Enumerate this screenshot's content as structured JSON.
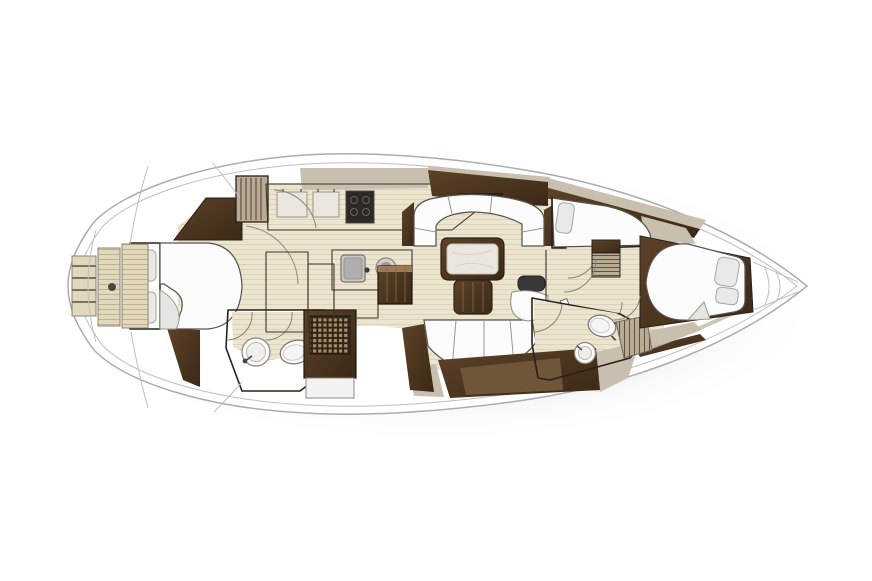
{
  "figure": {
    "kind": "sailing-yacht-interior-floor-plan",
    "view": "top-down deck plan",
    "bow_direction": "right",
    "stern_direction": "left"
  },
  "areas": {
    "swim_platform": "transom swim platform with teak steps",
    "aft_cabin": "aft double berth cabin",
    "aft_head": "aft head with sink and toilet",
    "shower": "shower with teak grate",
    "galley": "galley with sink, stove and counters",
    "companionway": "companionway steps",
    "saloon": "saloon with dinette table and settees",
    "nav_seat": "navigation seat",
    "guest_cabin": "starboard guest berth cabin",
    "forward_head": "forward head with sink and toilet",
    "corridor": "corridor with doors",
    "forward_cabin": "forward double berth cabin",
    "bow_deck": "bow deck with anchor locker"
  },
  "palette": {
    "background": "#ffffff",
    "hull_fill": "#ffffff",
    "hull_stroke": "#a9adb0",
    "hull_inner_line": "#c6c8ca",
    "shadow": "#d9dadc",
    "floor_base": "#ebe4cf",
    "floor_line": "#d9cdb2",
    "teak_base": "#e2d8bc",
    "teak_line": "#bdb093",
    "slat_base": "#b9ab94",
    "slat_line": "#5f5140",
    "wood_dark": "#3a2917",
    "wood_light": "#5d4227",
    "wood_lip": "#9b7b55",
    "taupe": "#c9bfae",
    "counter_gray": "#b7b5b3",
    "counter_gray2": "#a5a3a1",
    "counter_taupe": "#b3a796",
    "counter_white": "#f3f2f0",
    "marble": "#eae6dd",
    "grate_bg": "#2f2418",
    "grate_cell": "#a78e68",
    "stove": "#2b2826",
    "seat_dark": "#3a3836",
    "fixture_white": "#fbfbfa",
    "bed_white": "#fcfcfc",
    "pillow_gray": "#e9e9e7",
    "fold_gray": "#e6e5e2"
  }
}
